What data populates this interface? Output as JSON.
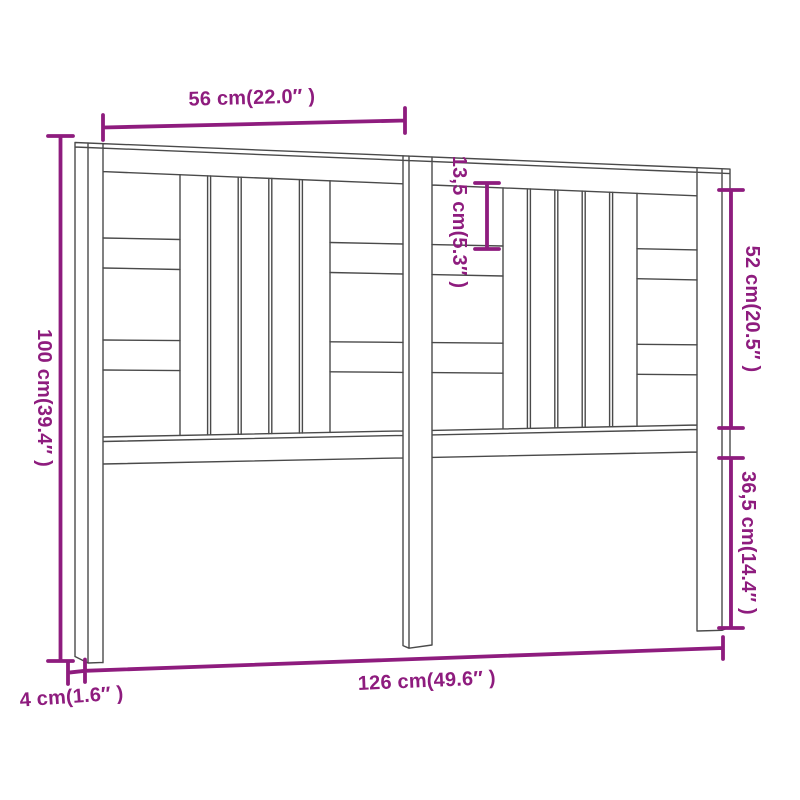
{
  "figure": {
    "title": "Headboard dimension diagram"
  },
  "colors": {
    "dimension": "#8E1C7E",
    "outline": "#4A4A4A",
    "background": "#FFFFFF"
  },
  "dimensions": {
    "top_width": "56 cm(22.0″ )",
    "slat_gap": "13,5 cm(5.3″ )",
    "upper_section_height": "52 cm(20.5″ )",
    "total_height": "100 cm(39.4″ )",
    "leg_below_height": "36,5 cm(14.4″ )",
    "total_width": "126 cm(49.6″ )",
    "thickness": "4 cm(1.6″ )"
  }
}
